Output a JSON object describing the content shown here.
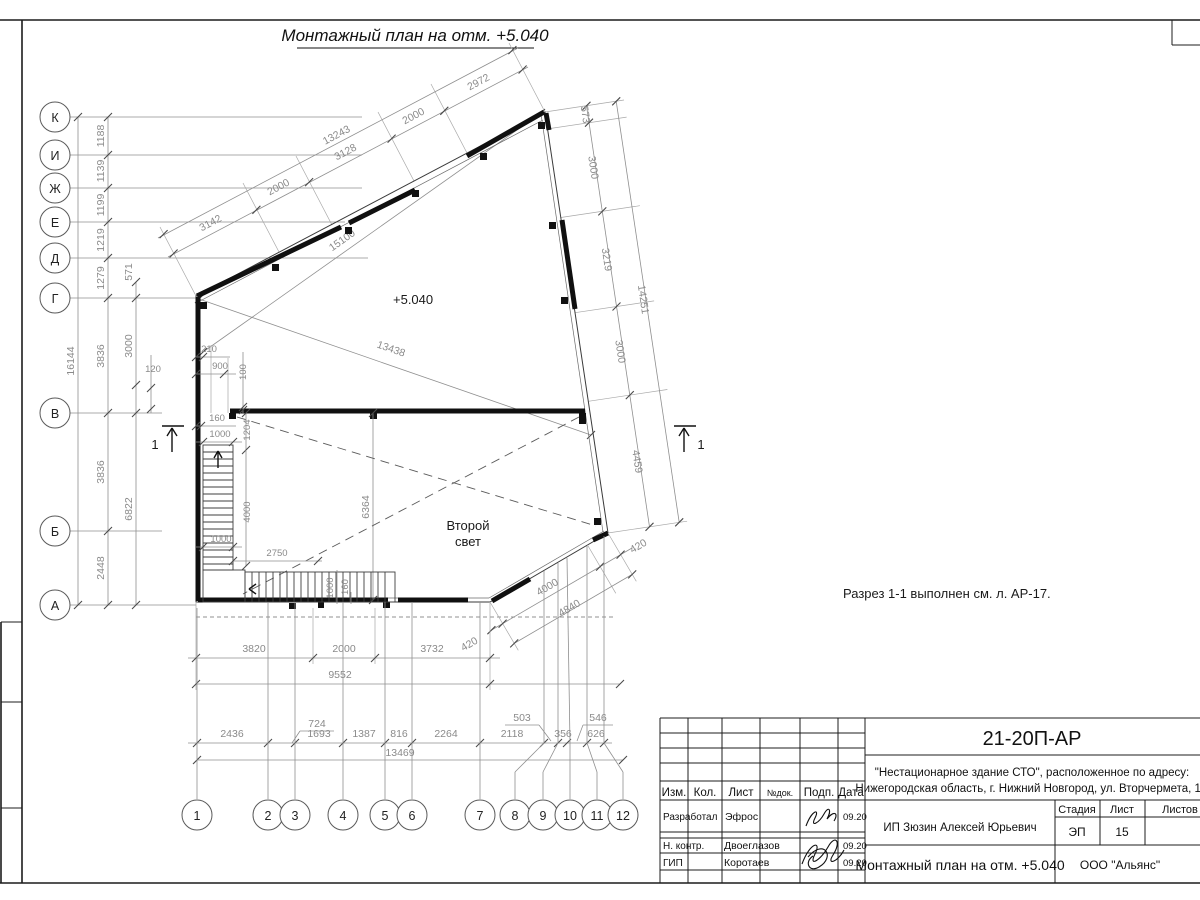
{
  "sheet": {
    "title": "Монтажный план на отм. +5.040",
    "note": "Разрез 1-1 выполнен см. л. АР-17."
  },
  "plan": {
    "elevation": "+5.040",
    "room_line1": "Второй",
    "room_line2": "свет",
    "section_mark": "1"
  },
  "axesLetters": [
    "К",
    "И",
    "Ж",
    "Е",
    "Д",
    "Г",
    "В",
    "Б",
    "А"
  ],
  "axesNumbers": [
    "1",
    "2",
    "3",
    "4",
    "5",
    "6",
    "7",
    "8",
    "9",
    "10",
    "11",
    "12"
  ],
  "dims": {
    "top": [
      "3142",
      "2000",
      "3128",
      "2000",
      "2972"
    ],
    "top_total": "13243",
    "right": [
      "573",
      "3000",
      "3219",
      "3000",
      "4459"
    ],
    "right_total": "14251",
    "corner_420": "420",
    "diag_15100": "15100",
    "diag_13438": "13438",
    "left_total": "16144",
    "left_col": [
      "1188",
      "1139",
      "1199",
      "1219",
      "1279",
      "3836",
      "3836",
      "2448"
    ],
    "left_6822": "6822",
    "left_571": "571",
    "left_3000": "3000",
    "left_120": "120",
    "st_210": "210",
    "st_900": "900",
    "st_100": "100",
    "st_160": "160",
    "st_1000": "1000",
    "st_1204": "1204",
    "st_4000": "4000",
    "st_1000b": "1000",
    "st_2750": "2750",
    "st_1000r": "1000",
    "st_160r": "160",
    "room_6364": "6364",
    "bottom": [
      "3820",
      "2000",
      "3732"
    ],
    "bottom_420": "420",
    "bottom_total": "9552",
    "chain": [
      "2436",
      "724",
      "1693",
      "1387",
      "816",
      "2264",
      "2118",
      "503",
      "356",
      "626",
      "546"
    ],
    "chain_total": "13469",
    "diag_4000": "4000",
    "diag_4840": "4840"
  },
  "title_block": {
    "code": "21-20П-АР",
    "address1": "\"Нестационарное здание СТО\", расположенное по адресу:",
    "address2": "Нижегородская область, г. Нижний Новгород, ул. Вторчермета, 1А",
    "header": {
      "izm": "Изм.",
      "kol": "Кол.",
      "list": "Лист",
      "ndok": "№док.",
      "podp": "Подп.",
      "data": "Дата"
    },
    "rows": [
      {
        "role": "Разработал",
        "name": "Эфрос",
        "date": "09.20"
      },
      {
        "role": "Н. контр.",
        "name": "Двоеглазов",
        "date": "09.20"
      },
      {
        "role": "ГИП",
        "name": "Коротаев",
        "date": "09.20"
      }
    ],
    "client": "ИП Зюзин Алексей Юрьевич",
    "doc_title": "Монтажный план на отм. +5.040",
    "stage_label": "Стадия",
    "sheet_label": "Лист",
    "sheets_label": "Листов",
    "stage": "ЭП",
    "sheet_num": "15",
    "org": "ООО \"Альянс\""
  }
}
